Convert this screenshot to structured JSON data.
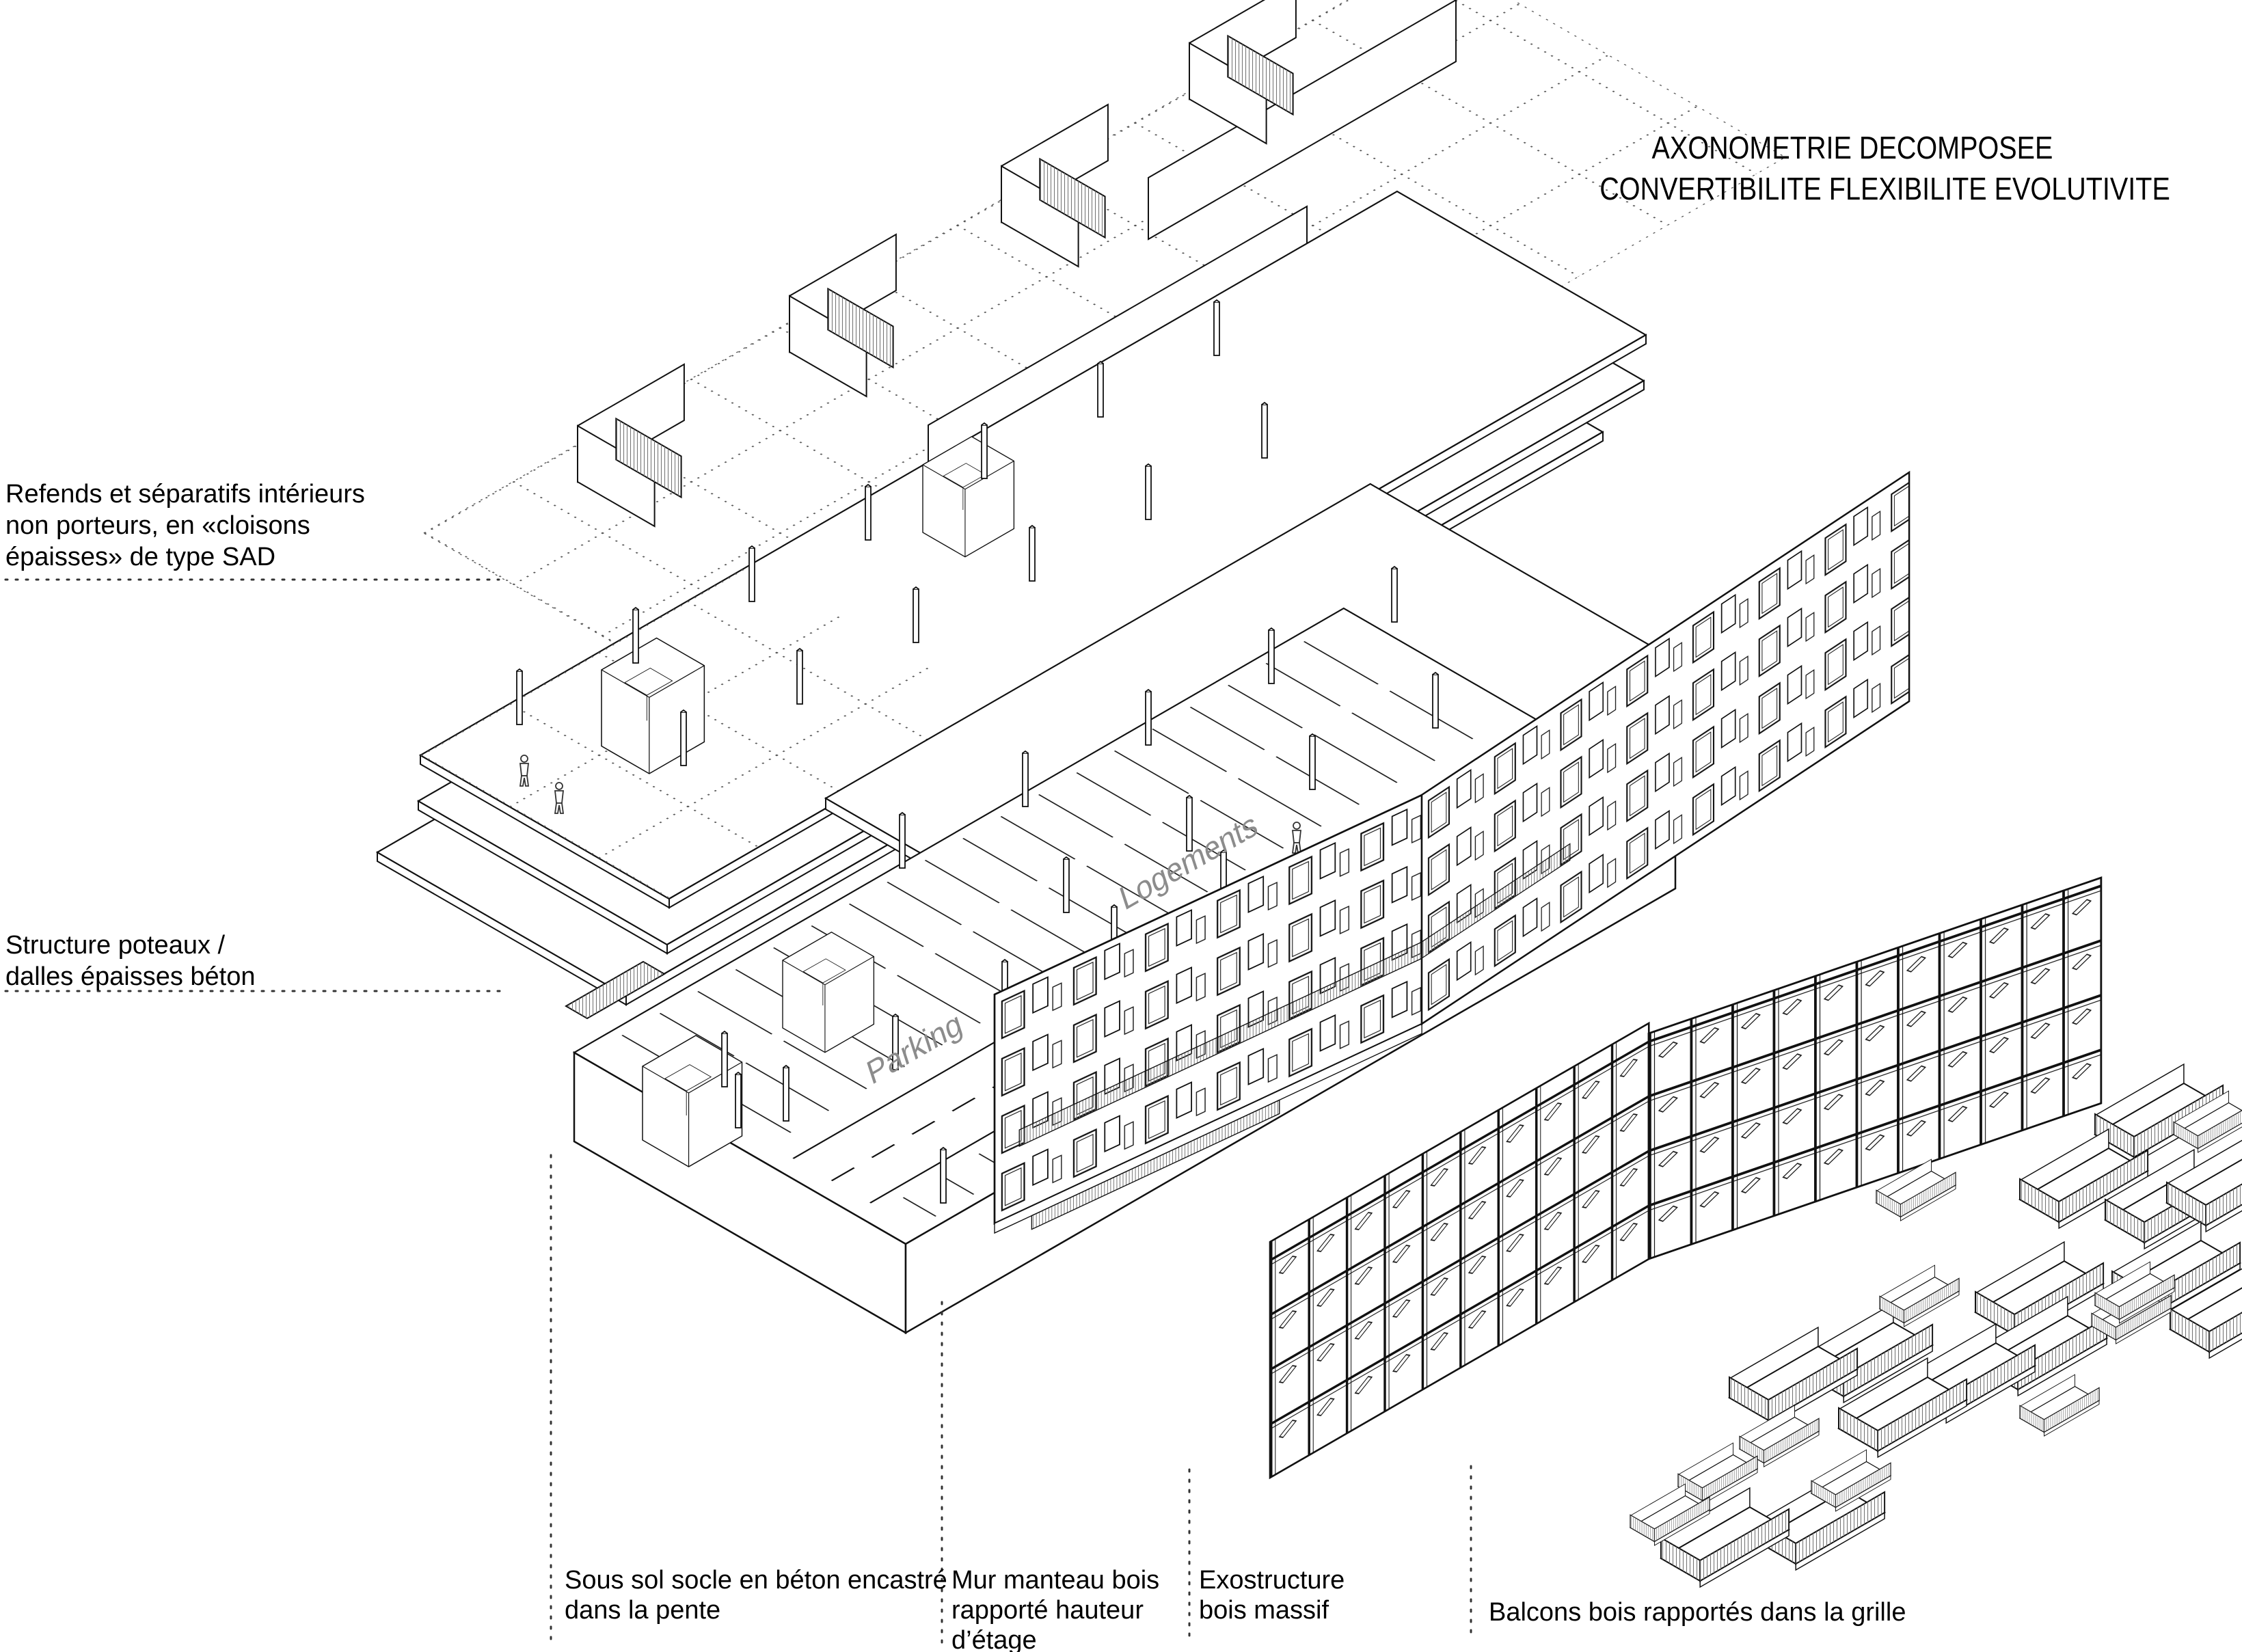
{
  "title": {
    "line1": "AXONOMETRIE DECOMPOSEE",
    "line2": "CONVERTIBILITE FLEXIBILITE EVOLUTIVITE"
  },
  "labels": {
    "refends": {
      "line1": "Refends et séparatifs intérieurs",
      "line2": "non porteurs, en «cloisons",
      "line3": "épaisses» de type SAD"
    },
    "structure": {
      "line1": "Structure poteaux /",
      "line2": "dalles épaisses béton"
    },
    "sous_sol": {
      "line1": "Sous sol socle en béton encastré",
      "line2": "dans la pente"
    },
    "mur_manteau": {
      "line1": "Mur manteau bois",
      "line2": "rapporté hauteur",
      "line3": "d’étage"
    },
    "exostructure": {
      "line1": "Exostructure",
      "line2": "bois massif"
    },
    "balcons": {
      "line1": "Balcons bois rapportés dans la grille"
    }
  },
  "drawing_labels": {
    "logements": "Logements",
    "parking": "Parking"
  },
  "colors": {
    "ink": "#111111",
    "label_gray": "#8c8c8c",
    "hatch_gray": "#777777",
    "background": "#ffffff"
  }
}
